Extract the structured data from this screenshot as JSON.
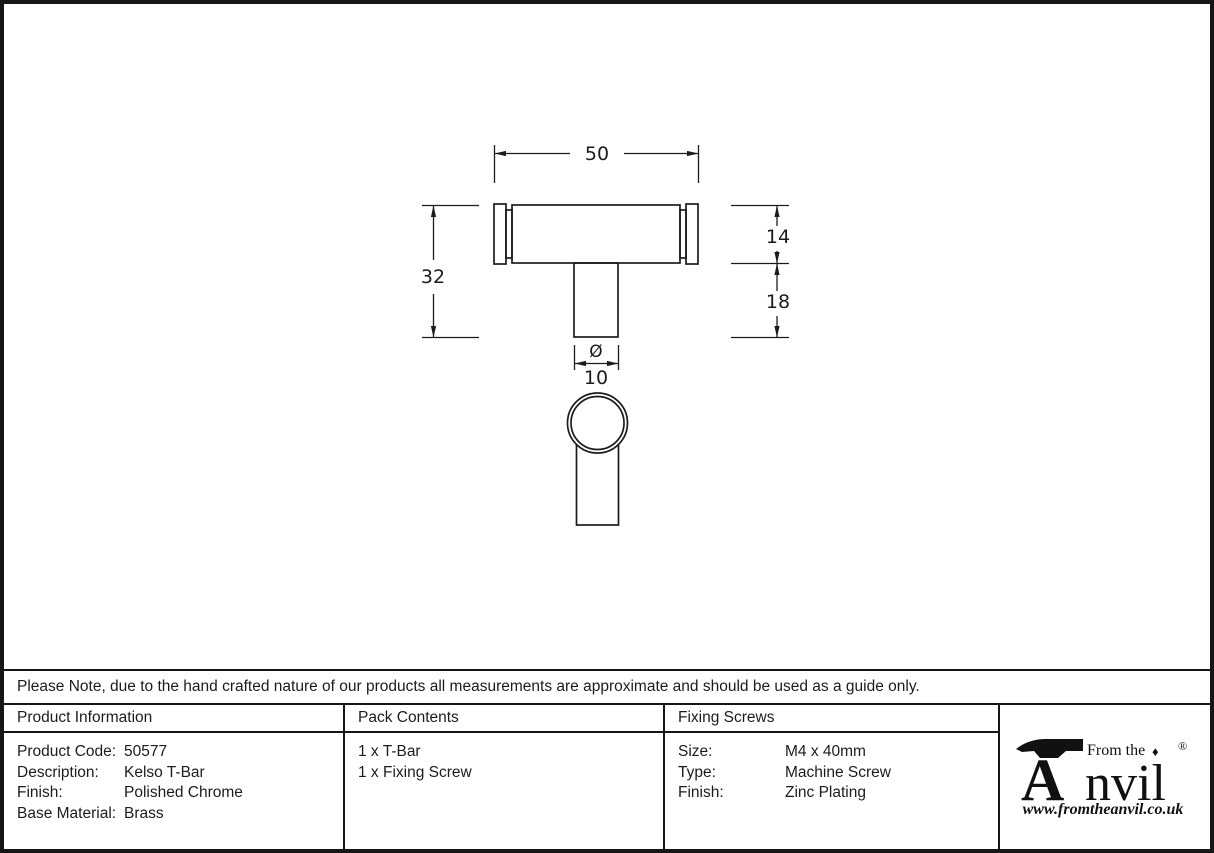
{
  "drawing": {
    "dim_width": "50",
    "dim_total_height": "32",
    "dim_bar_height": "14",
    "dim_stem_height": "18",
    "dia_symbol": "Ø",
    "dim_stem_dia": "10"
  },
  "note": "Please Note, due to the hand crafted nature of our products all measurements are approximate and should be used as a guide only.",
  "table": {
    "product_information": {
      "header": "Product Information",
      "rows": [
        {
          "label": "Product Code:",
          "value": "50577"
        },
        {
          "label": "Description:",
          "value": "Kelso T-Bar"
        },
        {
          "label": "Finish:",
          "value": "Polished Chrome"
        },
        {
          "label": "Base Material:",
          "value": "Brass"
        }
      ]
    },
    "pack_contents": {
      "header": "Pack Contents",
      "items": [
        "1 x T-Bar",
        "1 x Fixing Screw"
      ]
    },
    "fixing_screws": {
      "header": "Fixing Screws",
      "rows": [
        {
          "label": "Size:",
          "value": "M4 x 40mm"
        },
        {
          "label": "Type:",
          "value": "Machine Screw"
        },
        {
          "label": "Finish:",
          "value": "Zinc Plating"
        }
      ]
    }
  },
  "brand": {
    "prefix": "From the",
    "diamond": "♦",
    "name_initial": "A",
    "name_rest": "nvil",
    "registered": "®",
    "website": "www.fromtheanvil.co.uk"
  },
  "colors": {
    "ink": "#1c1c1c",
    "border": "#161616",
    "background": "#ffffff"
  }
}
